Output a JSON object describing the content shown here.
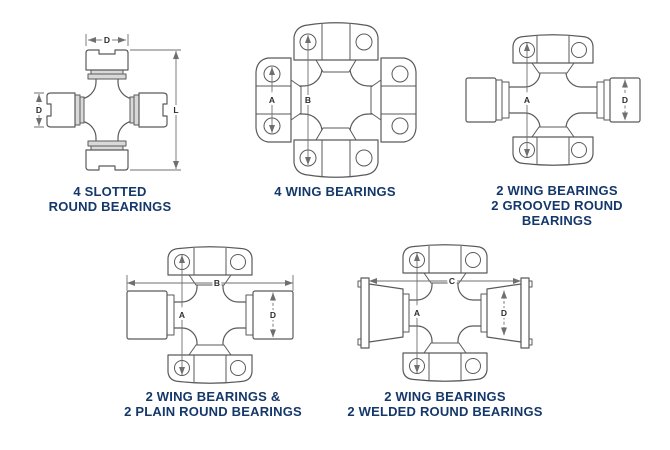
{
  "figure": {
    "background": "#ffffff",
    "caption_color": "#15386b",
    "outline_color": "#5a5a5a",
    "dimension_color": "#6f6f6f",
    "shade_color": "#d9d9d9"
  },
  "diagrams": [
    {
      "name": "4-slotted-round-bearings",
      "caption_lines": [
        "4 SLOTTED",
        "ROUND BEARINGS"
      ],
      "dimension_labels": {
        "top_diameter": "D",
        "left_diameter": "D",
        "length": "L"
      }
    },
    {
      "name": "4-wing-bearings",
      "caption_lines": [
        "4 WING BEARINGS"
      ],
      "dimension_labels": {
        "wing_hole_span": "A",
        "bearing_span": "B"
      }
    },
    {
      "name": "2-wing-2-grooved-round-bearings",
      "caption_lines": [
        "2 WING BEARINGS",
        "2 GROOVED ROUND BEARINGS"
      ],
      "dimension_labels": {
        "bearing_span": "A",
        "diameter": "D"
      }
    },
    {
      "name": "2-wing-2-plain-round-bearings",
      "caption_lines": [
        "2 WING BEARINGS &",
        "2 PLAIN ROUND BEARINGS"
      ],
      "dimension_labels": {
        "overall_width": "B",
        "bearing_span": "A",
        "diameter": "D"
      }
    },
    {
      "name": "2-wing-2-welded-round-bearings",
      "caption_lines": [
        "2 WING BEARINGS",
        "2 WELDED ROUND BEARINGS"
      ],
      "dimension_labels": {
        "overall_width": "C",
        "bearing_span": "A",
        "diameter": "D"
      }
    }
  ]
}
